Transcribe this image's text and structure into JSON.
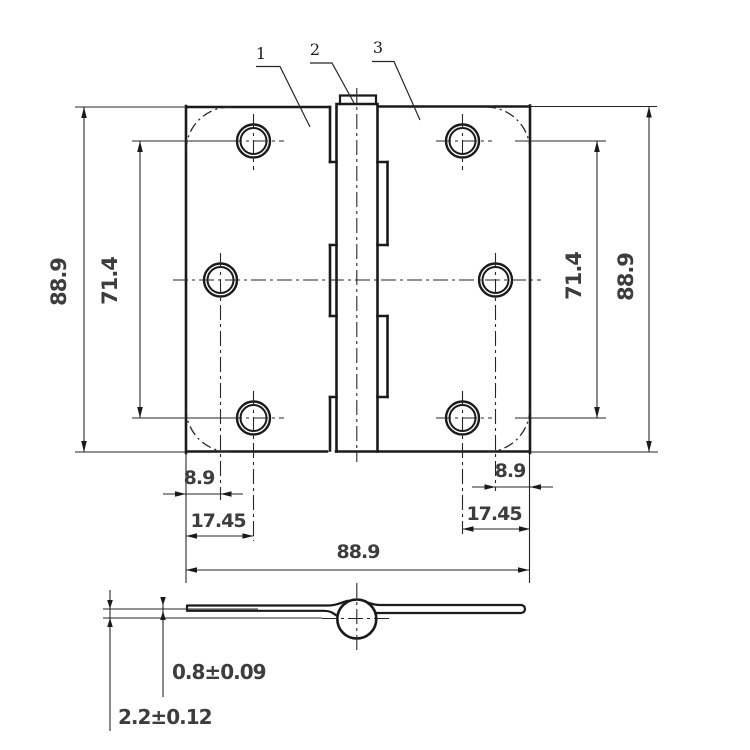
{
  "drawing_type": "butt-hinge-technical-drawing",
  "callouts": {
    "left_leaf": "1",
    "pin": "2",
    "right_leaf": "3"
  },
  "dimensions": {
    "left_height": "88.9",
    "left_hole_spacing": "71.4",
    "right_hole_spacing": "71.4",
    "right_height": "88.9",
    "left_center_hole_inset": "8.9",
    "left_corner_hole_inset": "17.45",
    "right_center_hole_inset": "8.9",
    "right_corner_hole_inset": "17.45",
    "open_width": "88.9",
    "leaf_thickness": "0.8±0.09",
    "closed_thickness": "2.2±0.12"
  },
  "colors": {
    "line": "#1a1a1a",
    "thin_line": "#262626",
    "dimension_text": "#3d3d3d",
    "background": "#ffffff"
  }
}
